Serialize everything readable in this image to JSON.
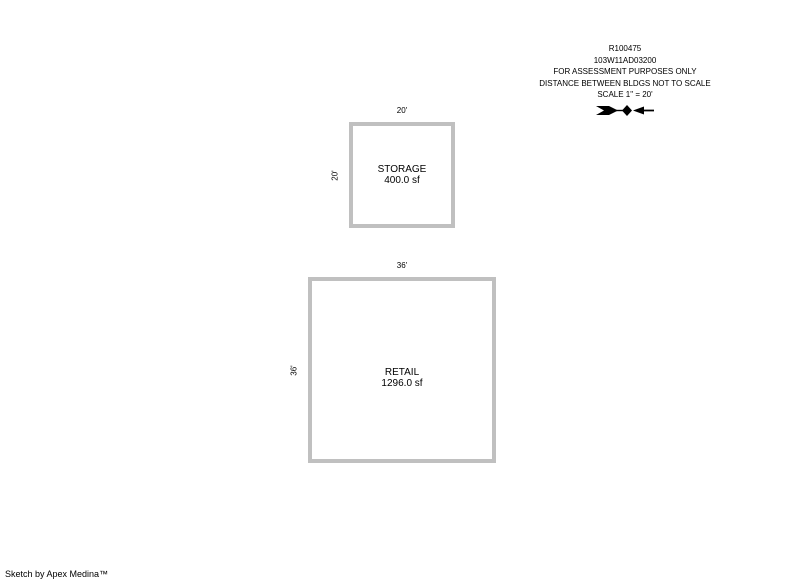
{
  "page": {
    "footer": "Sketch by Apex Medina™"
  },
  "header": {
    "lines": [
      "R100475",
      "103W11AD03200",
      "FOR ASSESSMENT PURPOSES ONLY",
      "DISTANCE BETWEEN BLDGS NOT TO SCALE",
      "SCALE 1\" = 20'"
    ],
    "compass_icon": "north-arrow"
  },
  "buildings": [
    {
      "name": "STORAGE",
      "area": "400.0 sf",
      "width_label": "20'",
      "height_label": "20'"
    },
    {
      "name": "RETAIL",
      "area": "1296.0 sf",
      "width_label": "36'",
      "height_label": "36'"
    }
  ],
  "colors": {
    "outline": "#c0c0c0",
    "text": "#000000",
    "background": "#ffffff"
  }
}
